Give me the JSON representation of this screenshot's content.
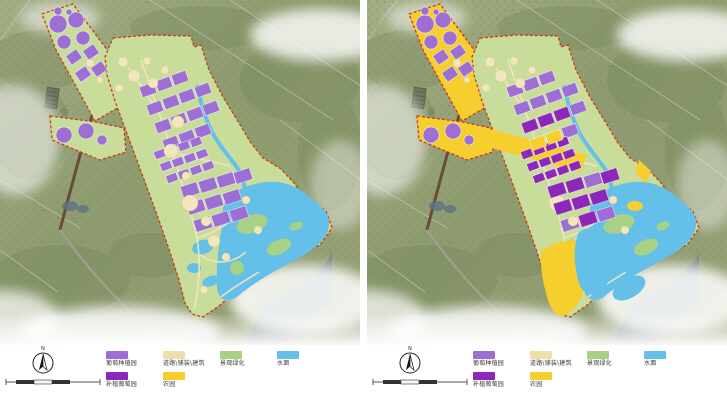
{
  "legend": {
    "items": [
      {
        "label": "葡萄种植园",
        "color": "vineyard"
      },
      {
        "label": "道路\\铺装\\建筑",
        "color": "road_paving"
      },
      {
        "label": "景观绿化",
        "color": "greening"
      },
      {
        "label": "水面",
        "color": "water"
      },
      {
        "label": "补植葡萄园",
        "color": "replant"
      },
      {
        "label": "农园",
        "color": "farm"
      }
    ]
  },
  "compass": {
    "north_label": "N"
  },
  "palette": {
    "vineyard": "#9d6fd4",
    "replant": "#8d27ba",
    "road_paving": "#ece0a8",
    "greening": "#a9d185",
    "water": "#64c0e8",
    "farm": "#f6cf2f",
    "site_fill": "#c9dd9b",
    "boundary": "#cf3a17",
    "bg_base": "#95a175",
    "bg_dark": "#74855a",
    "road_dark": "#6b4a3c",
    "river_dark": "#6f8494",
    "path_cream": "#f0e6bd"
  }
}
